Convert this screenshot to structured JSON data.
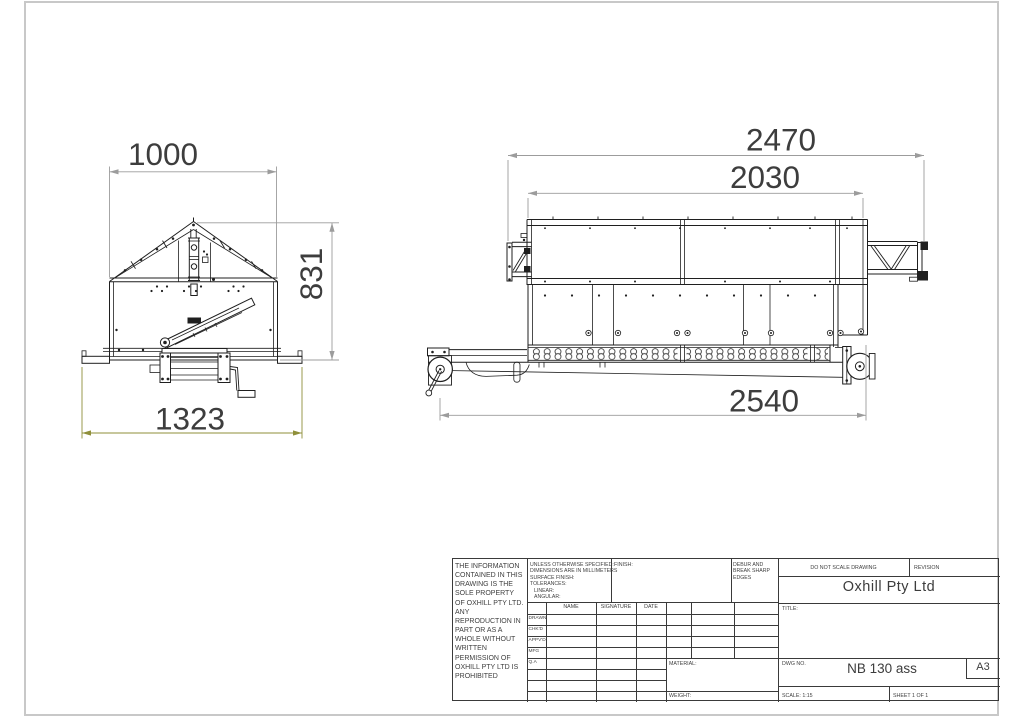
{
  "colors": {
    "line": "#1f1f1f",
    "dimension_line": "#9c9c9c",
    "dimension_text": "#3d3d3d",
    "highlight_dimension_line": "#8f8f3a",
    "sheet_border": "#c8c8c8"
  },
  "dimensions": {
    "front_width": "1000",
    "front_height": "831",
    "front_base_width": "1323",
    "side_overall_length": "2470",
    "side_body_length": "2030",
    "side_chassis_length": "2540"
  },
  "title_block": {
    "legal_notice": "THE INFORMATION CONTAINED IN THIS DRAWING IS THE SOLE PROPERTY OF OXHILL PTY LTD. ANY REPRODUCTION IN PART OR AS A WHOLE WITHOUT WRITTEN PERMISSION OF OXHILL PTY LTD IS PROHIBITED",
    "spec_lines": [
      "UNLESS OTHERWISE SPECIFIED:",
      "DIMENSIONS ARE IN MILLIMETERS",
      "SURFACE FINISH:",
      "TOLERANCES:",
      "LINEAR:",
      "ANGULAR:"
    ],
    "finish_label": "FINISH:",
    "debur_note": "DEBUR AND BREAK SHARP EDGES",
    "do_not_scale": "DO NOT SCALE DRAWING",
    "revision_label": "REVISION",
    "company_name": "Oxhill Pty Ltd",
    "title_label": "TITLE:",
    "approval_headers": [
      "NAME",
      "SIGNATURE",
      "DATE"
    ],
    "approval_rows": [
      "DRAWN",
      "CHK'D",
      "APPV'D",
      "MFG",
      "Q.A"
    ],
    "material_label": "MATERIAL:",
    "weight_label": "WEIGHT:",
    "dwg_label": "DWG NO.",
    "dwg_number": "NB 130 ass",
    "paper_size": "A3",
    "scale_label": "SCALE: 1:15",
    "sheet_label": "SHEET 1 OF 1"
  }
}
